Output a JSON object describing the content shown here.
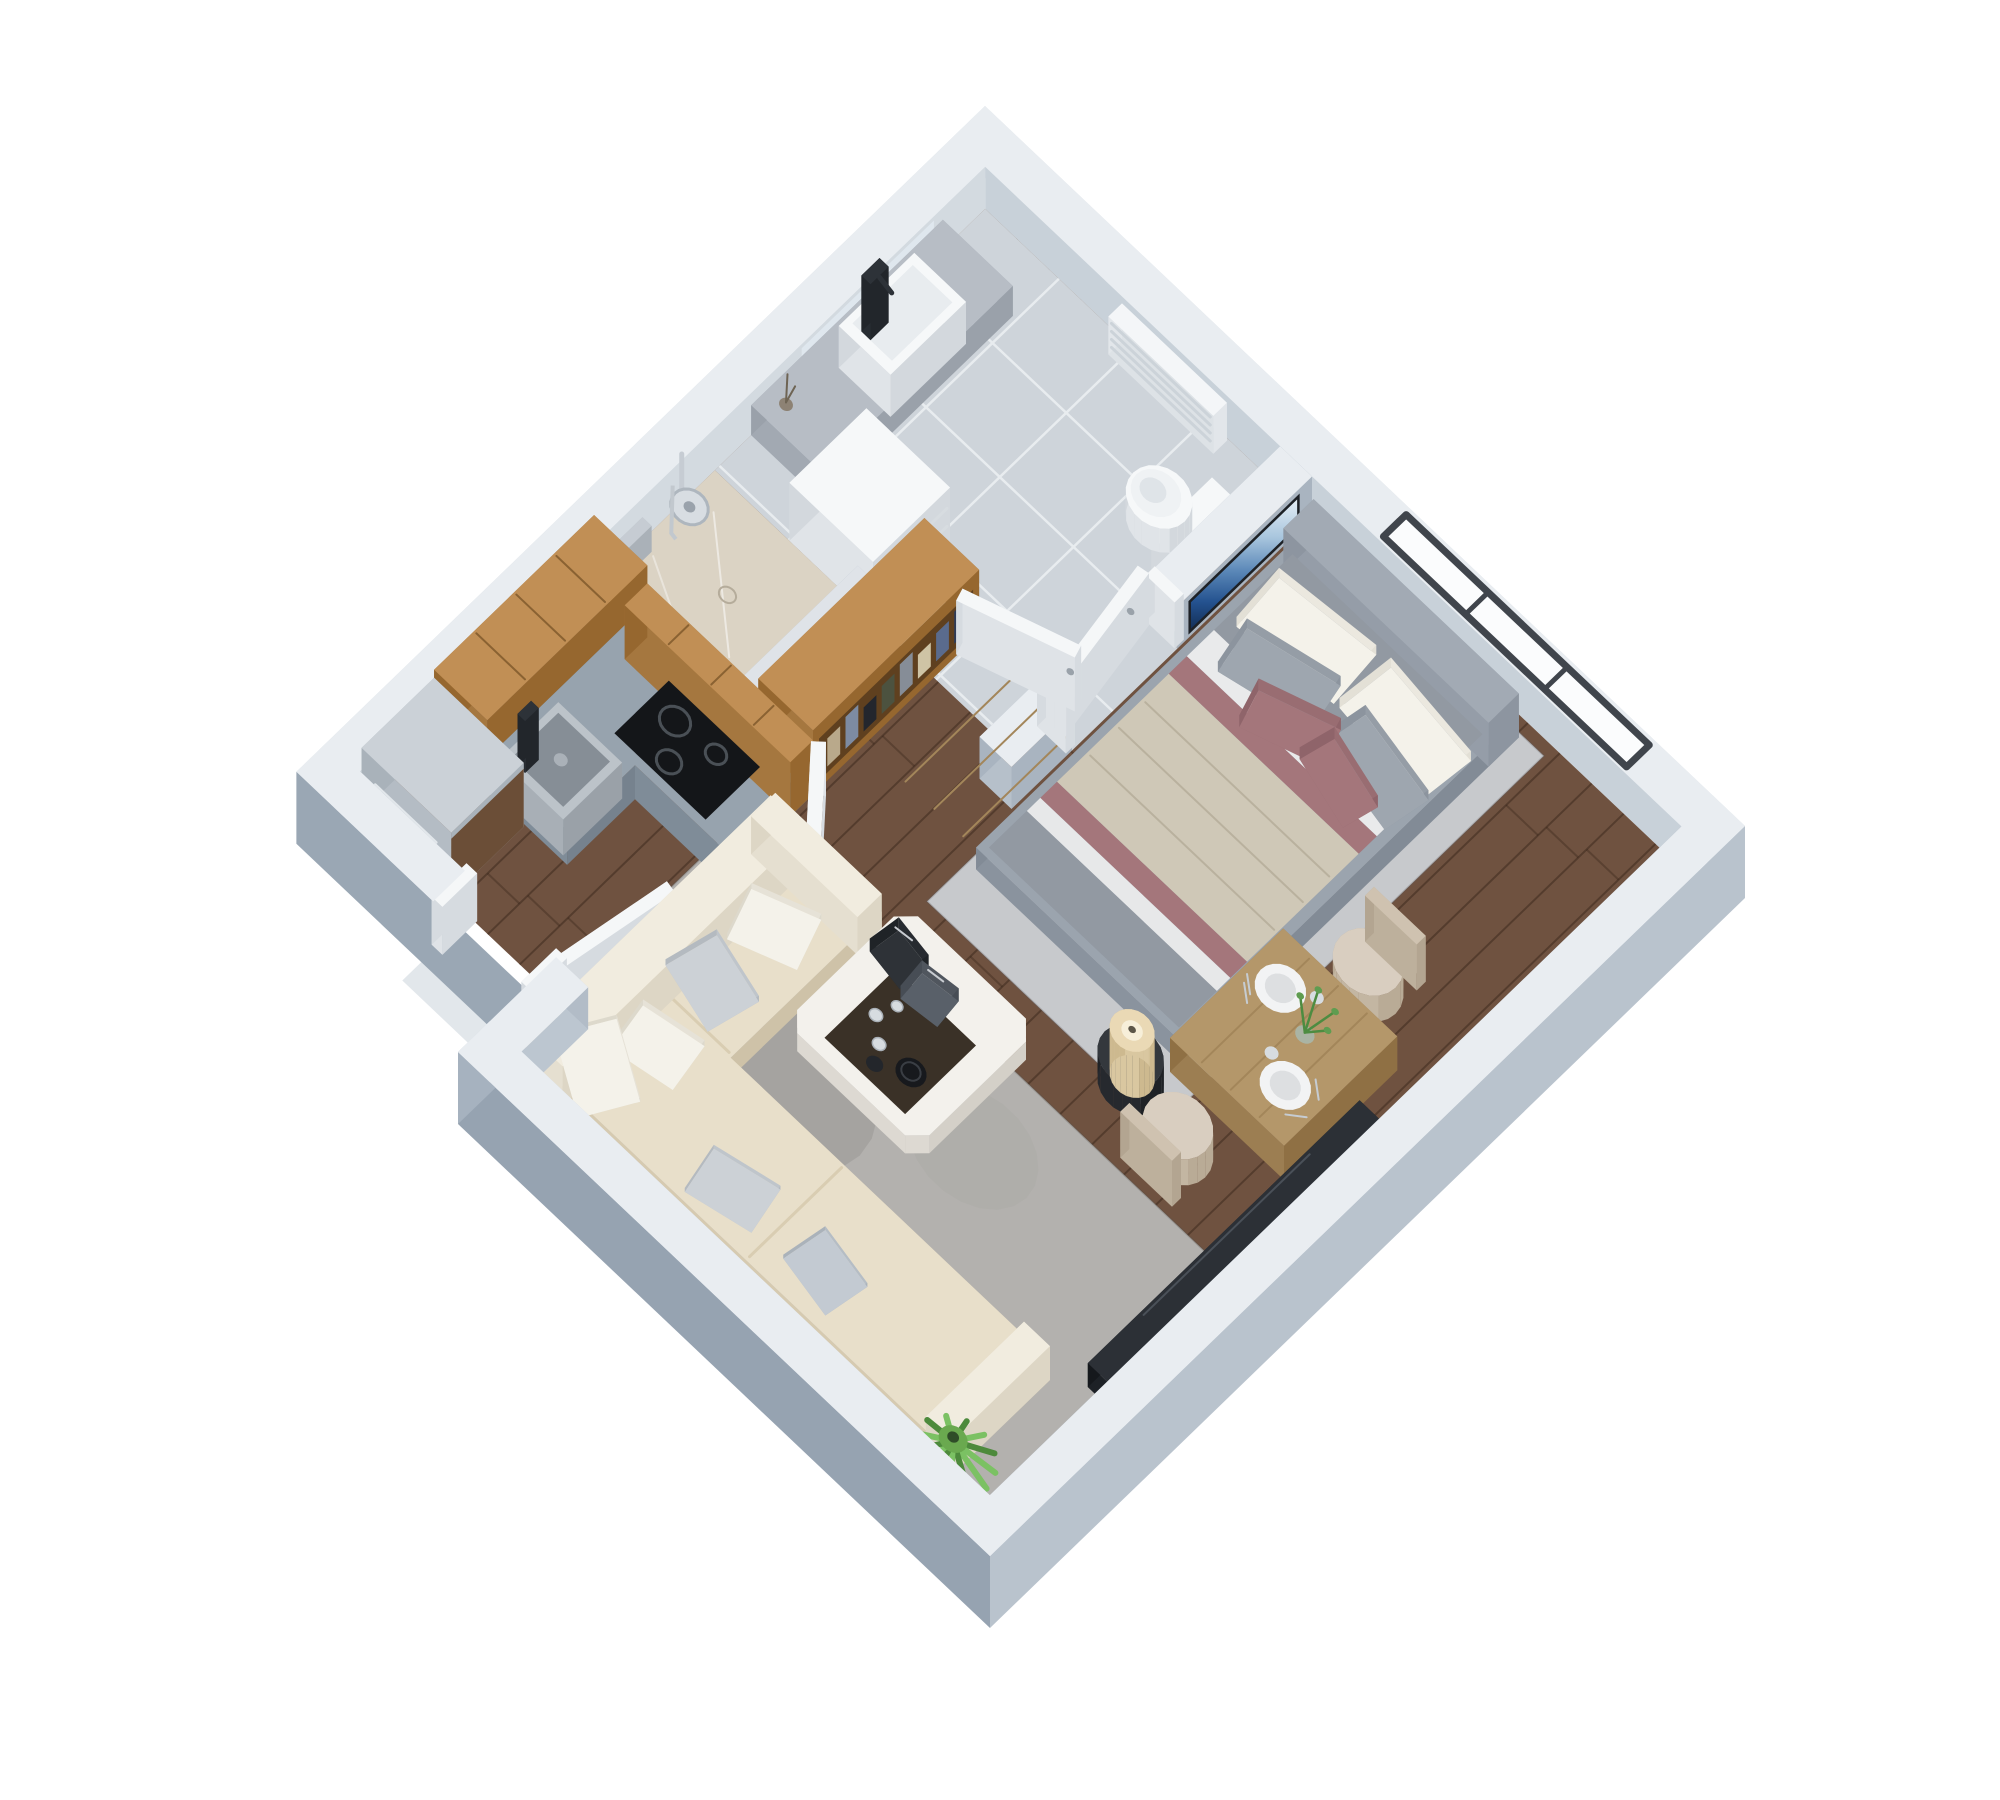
{
  "scene": {
    "kind": "isometric-3d-floor-plan-render",
    "background": "#ffffff",
    "projection": {
      "origin": [
        985,
        148
      ],
      "axisX": [
        0.76,
        0.72
      ],
      "axisY": [
        -0.755,
        0.73
      ],
      "wallHeight": 42
    },
    "palette": {
      "wallTop": "#e9edf1",
      "wallOuterLight": "#dadfe4",
      "wallOuterNW": "#d2d8de",
      "wallOuterSE": "#b9c3cd",
      "wallOuterSW": "#96a3b1",
      "wallOuterStep": "#a6b2bf",
      "wallOuterNotch": "#9aa7b4",
      "wallInnerNE": "#c8d1d9",
      "wallInnerNW": "#d3dae0",
      "wallInnerSE": "#a9b4c0",
      "wallInnerSW": "#b6c0ca",
      "wallInnerStep": "#bcc6d0",
      "wallInnerNotch": "#b2bcc7",
      "wood": "#c18f55",
      "woodSideX": "#96672f",
      "woodSideY": "#a5773f",
      "woodSeam": "#8a6232",
      "granite": "#97a3ae",
      "graniteSideX": "#76828e",
      "graniteSideY": "#7f8c98",
      "floorWood": "#6f5240",
      "plankLine": "rgba(42,27,17,0.38)",
      "tile": "#ced4da",
      "grout": "#e8ecef",
      "showerFloor": "#dbd3c4",
      "rugBedroom": "#c7c9cc",
      "rugLiving": "#b3b1ae",
      "bedFrame": "#9ba4ae",
      "headboard": "#a2aab4",
      "duvetGray": "#9299a2",
      "sheetWhite": "#e9eaeb",
      "blanketBeige": "#cfc8b7",
      "throwMauve": "#a4767b",
      "pillowWhite": "#f4f2ea",
      "pillowGray": "#9ea6af",
      "sofaSeat": "#e8dfca",
      "sofaBack": "#f1ecdf",
      "sofaPillowGray": "#ccd1d6",
      "sofaPillowBlue": "#c3cad2",
      "tableWood": "#b4976a",
      "tableWoodSideX": "#8f7044",
      "tableWoodSideY": "#9c7e52",
      "chairBeige": "#d9cec0",
      "mediaDark": "#2c3036",
      "sideTableDark": "#34383d",
      "lampCream": "#ead9b5",
      "fridgeSteel": "#cbd1d7",
      "fridgeWoodPanel": "#6b4e37",
      "doorWhite": "#f5f7f8",
      "doorSideX": "#d6dbe0",
      "doorSideY": "#dfe3e7",
      "fixtureWhite": "#f6f8f9",
      "fixtureSideX": "#d3d8dd",
      "fixtureSideY": "#e0e4e8",
      "chrome": "#c6ccd3",
      "cooktopBlack": "#141619",
      "sinkSteel": "#bcc3c9",
      "windowFrame": "#40454c",
      "glassWhite": "#fbfcfd",
      "tvTop": "#e9f1f7",
      "tvMid": "#a9c6de",
      "tvDeep": "#24528f",
      "tvBottom": "#122c52",
      "plantGreen": "#4d8a3c",
      "plantGreenLight": "#7bc163",
      "plantCenter": "#6aa94f"
    },
    "rooms": [
      {
        "id": "bathroom",
        "label": "bathroom"
      },
      {
        "id": "shower",
        "label": "shower"
      },
      {
        "id": "kitchen",
        "label": "kitchen"
      },
      {
        "id": "wardrobe-area",
        "label": "wardrobe"
      },
      {
        "id": "living-room",
        "label": "living room"
      },
      {
        "id": "dining-area",
        "label": "dining area"
      },
      {
        "id": "bedroom",
        "label": "sleeping area"
      },
      {
        "id": "entry",
        "label": "entry"
      }
    ],
    "layers": [
      {
        "id": "far-walls",
        "label": "outer walls (north corner)"
      },
      {
        "id": "window",
        "label": "window with dark frame"
      },
      {
        "id": "wood-floor",
        "label": "walnut plank floor"
      },
      {
        "id": "bathroom-floor",
        "label": "gray tile floor"
      },
      {
        "id": "shower-floor",
        "label": "beige marble shower floor"
      },
      {
        "id": "bedroom-rug",
        "label": "light gray bedroom rug"
      },
      {
        "id": "living-rug",
        "label": "gray living room rug"
      },
      {
        "id": "towel-radiator",
        "label": "white towel radiator"
      },
      {
        "id": "vanity",
        "label": "bathroom vanity with basin and black faucet"
      },
      {
        "id": "toilet",
        "label": "toilet"
      },
      {
        "id": "partition-wall",
        "label": "bathroom partition wall"
      },
      {
        "id": "wall-tv",
        "label": "wall mounted TV with blue screen"
      },
      {
        "id": "shower-fixture",
        "label": "chrome shower set"
      },
      {
        "id": "shelf-unit",
        "label": "white shelf unit"
      },
      {
        "id": "shower-half-wall",
        "label": "shower half wall"
      },
      {
        "id": "bed",
        "label": "double bed with gray, beige and mauve bedding"
      },
      {
        "id": "wardrobe",
        "label": "open wardrobe with hanging clothes"
      },
      {
        "id": "kitchen-uppers",
        "label": "oak kitchen cabinets"
      },
      {
        "id": "kitchen-counter",
        "label": "granite counter with sink and cooktop"
      },
      {
        "id": "dining-chair-1",
        "label": "beige dining chair"
      },
      {
        "id": "dining-table",
        "label": "dining table set for two"
      },
      {
        "id": "bedside-lamp",
        "label": "side table with cream lamp"
      },
      {
        "id": "dining-chair-2",
        "label": "beige dining chair"
      },
      {
        "id": "bathroom-door",
        "label": "open bathroom door"
      },
      {
        "id": "wardrobe-doors",
        "label": "open wardrobe doors"
      },
      {
        "id": "fridge",
        "label": "stainless fridge"
      },
      {
        "id": "media-console",
        "label": "dark media console"
      },
      {
        "id": "entry-door",
        "label": "open entry door"
      },
      {
        "id": "sofa",
        "label": "cream sectional sofa with pillows"
      },
      {
        "id": "coffee-table",
        "label": "white coffee table with tray"
      },
      {
        "id": "plant",
        "label": "green potted plant"
      },
      {
        "id": "near-walls",
        "label": "outer walls (south corner)"
      }
    ],
    "clothesColors": [
      "#2e3b57",
      "#5a6b8d",
      "#cfc4a5",
      "#868d97",
      "#4c523f",
      "#23262d",
      "#7d8ba2",
      "#b9a98b"
    ]
  }
}
